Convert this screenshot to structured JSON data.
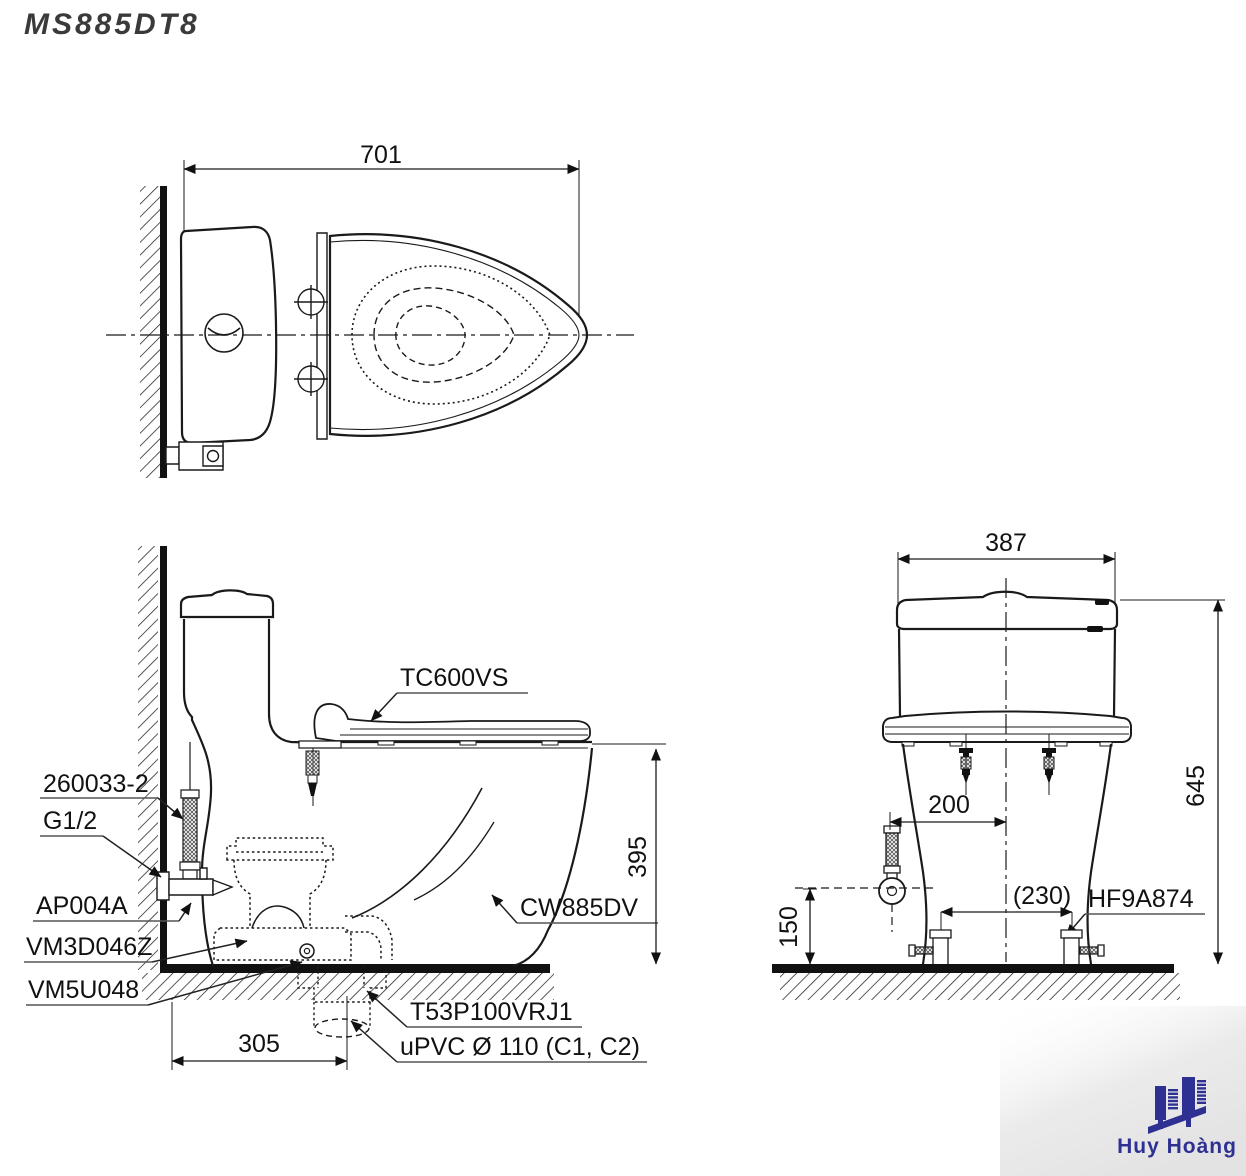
{
  "title": "MS885DT8",
  "top_view": {
    "dims": {
      "depth": "701"
    }
  },
  "side_view": {
    "labels": {
      "seat": "TC600VS",
      "hose": "260033-2",
      "thread": "G1/2",
      "stop_valve": "AP004A",
      "fitting": "VM3D046Z",
      "gasket": "VM5U048",
      "bowl": "CW885DV",
      "connector": "T53P100VRJ1",
      "pipe": "uPVC Ø 110 (C1, C2)"
    },
    "dims": {
      "rim_height": "395",
      "rough_in": "305"
    }
  },
  "front_view": {
    "labels": {
      "bolt_cap": "HF9A874"
    },
    "dims": {
      "width": "387",
      "total_height": "645",
      "supply_offset": "200",
      "bolt_spacing": "(230)",
      "supply_height": "150"
    }
  },
  "logo": {
    "name": "Huy Hoàng"
  },
  "colors": {
    "line": "#1a1a1a",
    "logo_blue": "#2e3192"
  }
}
